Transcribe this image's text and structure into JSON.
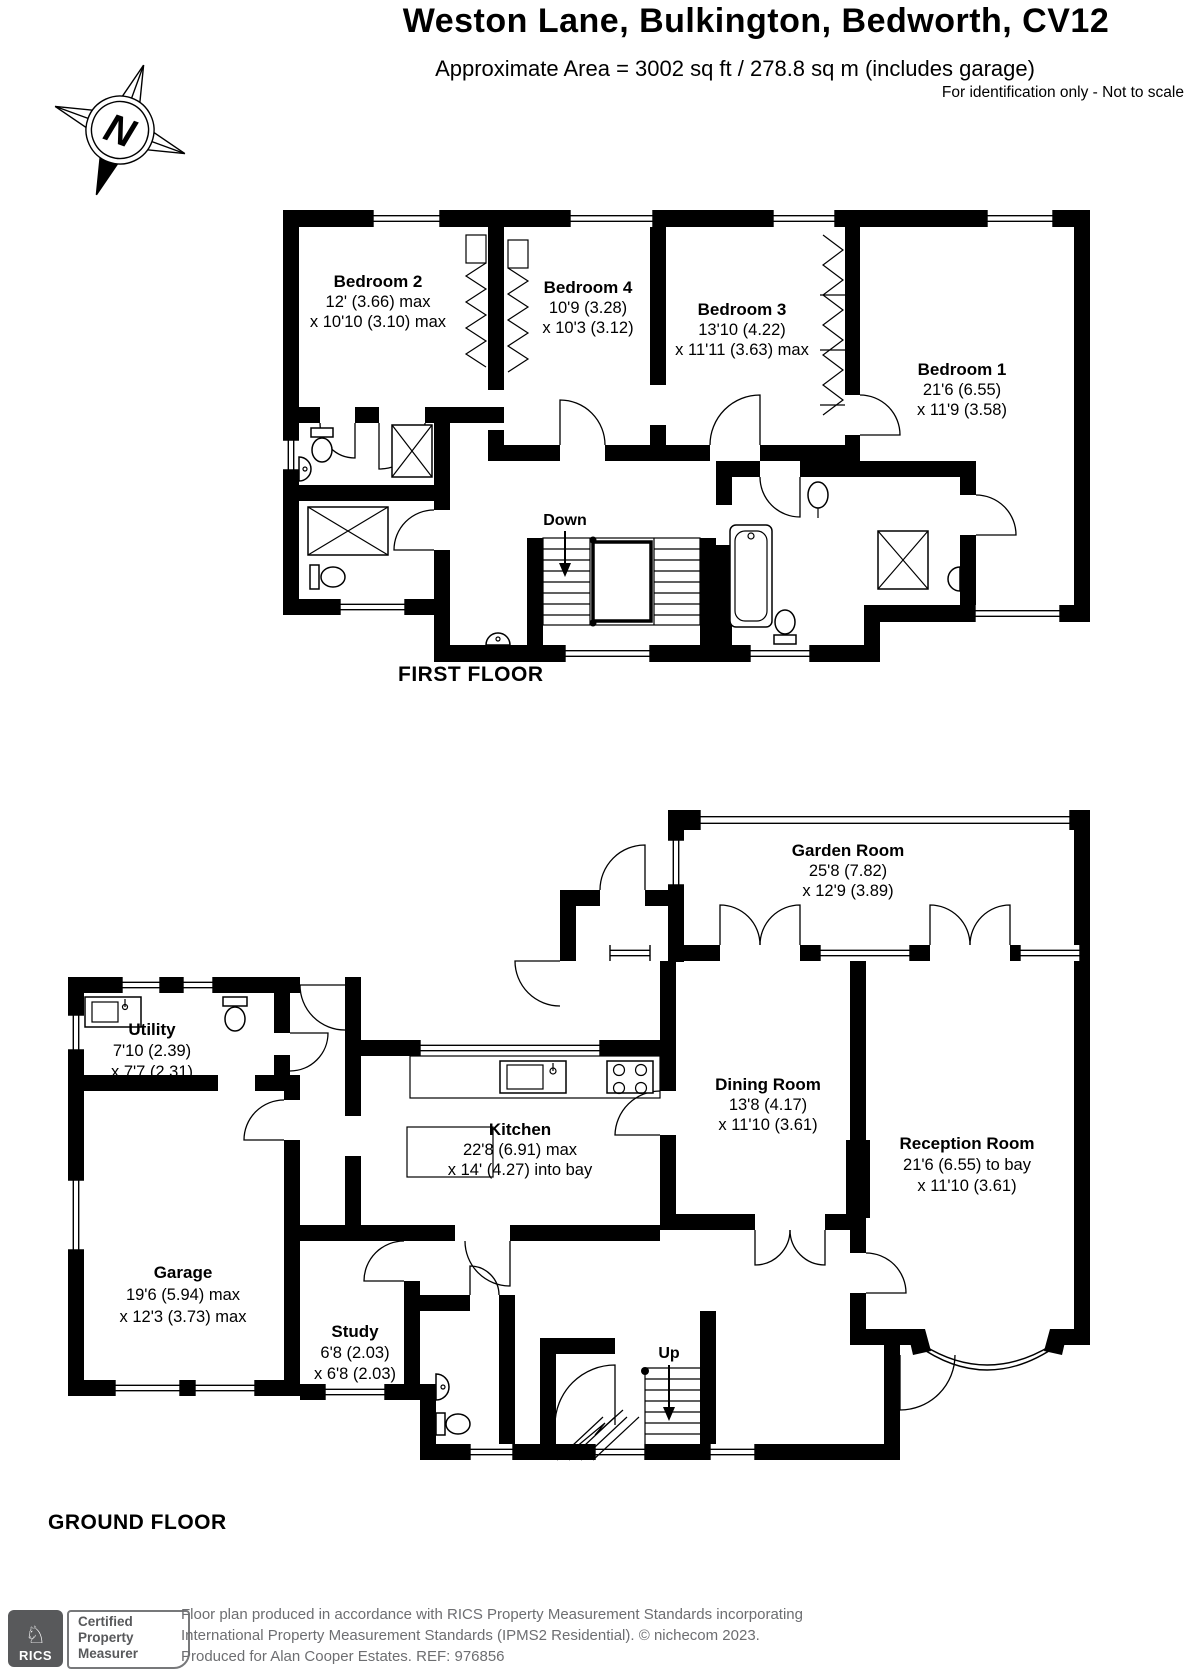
{
  "header": {
    "title": "Weston Lane, Bulkington, Bedworth, CV12",
    "subtitle": "Approximate Area = 3002 sq ft / 278.8 sq m (includes garage)",
    "disclaimer": "For identification only - Not to scale",
    "compass": "N"
  },
  "first_floor": {
    "label": "FIRST FLOOR",
    "stair_label": "Down",
    "rooms": [
      {
        "name": "Bedroom 2",
        "dim1": "12' (3.66) max",
        "dim2": "x 10'10 (3.10) max"
      },
      {
        "name": "Bedroom 4",
        "dim1": "10'9 (3.28)",
        "dim2": "x 10'3 (3.12)"
      },
      {
        "name": "Bedroom 3",
        "dim1": "13'10 (4.22)",
        "dim2": "x 11'11 (3.63) max"
      },
      {
        "name": "Bedroom 1",
        "dim1": "21'6 (6.55)",
        "dim2": "x 11'9 (3.58)"
      }
    ]
  },
  "ground_floor": {
    "label": "GROUND FLOOR",
    "stair_label": "Up",
    "rooms": [
      {
        "name": "Garden Room",
        "dim1": "25'8 (7.82)",
        "dim2": "x 12'9 (3.89)"
      },
      {
        "name": "Utility",
        "dim1": "7'10 (2.39)",
        "dim2": "x 7'7 (2.31)"
      },
      {
        "name": "Kitchen",
        "dim1": "22'8 (6.91) max",
        "dim2": "x 14' (4.27) into bay"
      },
      {
        "name": "Dining Room",
        "dim1": "13'8 (4.17)",
        "dim2": "x 11'10 (3.61)"
      },
      {
        "name": "Reception Room",
        "dim1": "21'6 (6.55) to bay",
        "dim2": "x 11'10 (3.61)"
      },
      {
        "name": "Garage",
        "dim1": "19'6 (5.94) max",
        "dim2": "x 12'3 (3.73) max"
      },
      {
        "name": "Study",
        "dim1": "6'8 (2.03)",
        "dim2": "x 6'8 (2.03)"
      }
    ]
  },
  "footer": {
    "rics": "RICS",
    "cert": [
      "Certified",
      "Property",
      "Measurer"
    ],
    "line1": "Floor plan produced in accordance with RICS Property Measurement Standards incorporating",
    "line2": "International Property Measurement Standards (IPMS2 Residential).   © nichecom 2023.",
    "line3": "Produced for Alan Cooper Estates.   REF: 976856"
  },
  "colors": {
    "wall": "#000000",
    "footer_text": "#6d6e71",
    "logo_gray": "#58595b"
  }
}
